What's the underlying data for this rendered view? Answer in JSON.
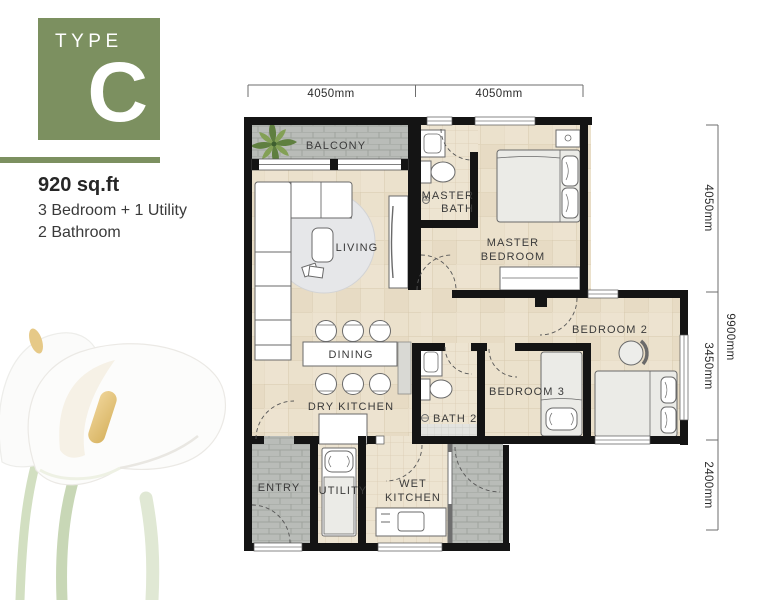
{
  "panel": {
    "type_label": "TYPE",
    "type_letter": "C",
    "area": "920 sq.ft",
    "features": [
      "3 Bedroom + 1 Utility",
      "2 Bathroom"
    ]
  },
  "dimensions": {
    "top": [
      "4050mm",
      "4050mm"
    ],
    "right_segments": [
      "4050mm",
      "3450mm",
      "2400mm"
    ],
    "right_total": "9900mm"
  },
  "rooms": {
    "balcony": "BALCONY",
    "living": "LIVING",
    "dining": "DINING",
    "dry_kitchen": "DRY KITCHEN",
    "master_bath_line1": "MASTER",
    "master_bath_line2": "BATH",
    "master_bedroom_line1": "MASTER",
    "master_bedroom_line2": "BEDROOM",
    "bedroom2": "BEDROOM 2",
    "bedroom3": "BEDROOM 3",
    "bath2": "BATH 2",
    "entry": "ENTRY",
    "utility": "UTILITY",
    "wet_kitchen_line1": "WET",
    "wet_kitchen_line2": "KITCHEN"
  },
  "colors": {
    "brand_green": "#7c9060",
    "wall": "#141414",
    "floor_beige": "#ebe1cc",
    "floor_gray": "#b9bcb8",
    "text_dark": "#2b2b2b"
  }
}
